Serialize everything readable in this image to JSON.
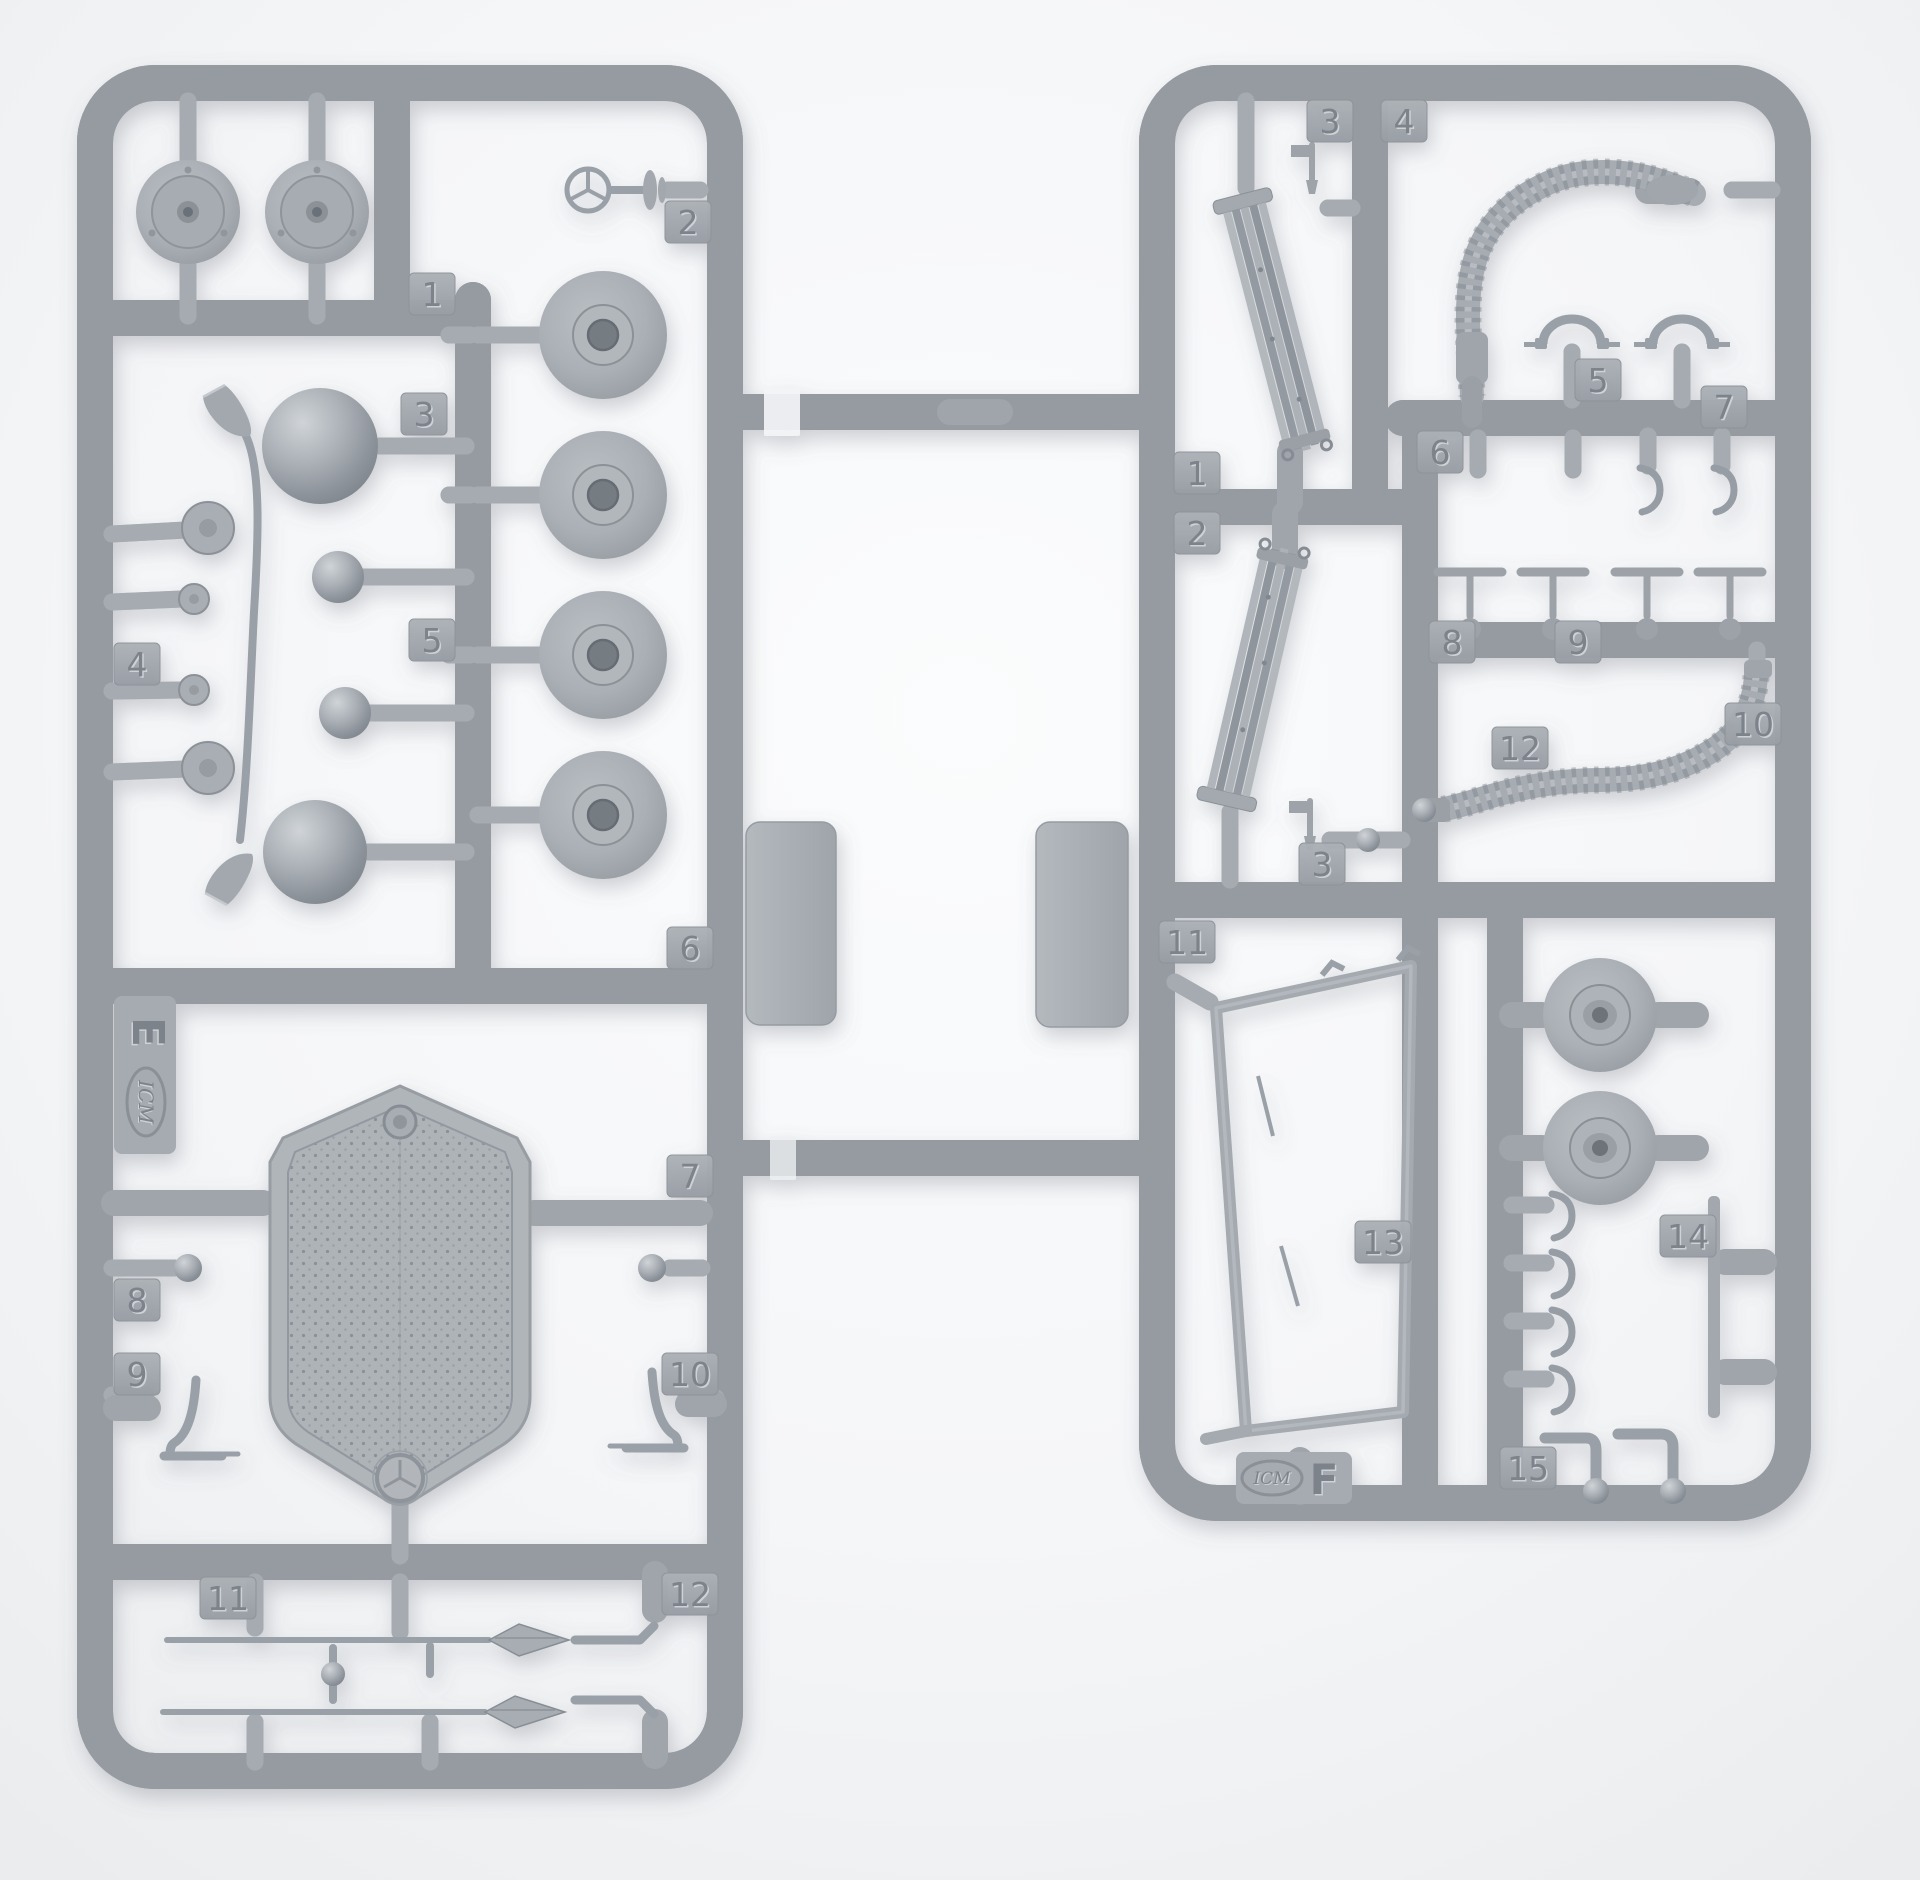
{
  "photo": {
    "subject": "Two light-gray injection-molded plastic model kit sprues photographed on a white background",
    "sprue_count": 2
  },
  "colors": {
    "background": "#f4f5f7",
    "plastic": "#a6abb1",
    "plastic_light": "#ccd0d5",
    "plastic_dark": "#81878e",
    "emboss": "#7d838a",
    "emboss_light": "#ced2d6",
    "sticker": "#f3f4f6"
  },
  "sprue_e": {
    "brand": "ICM",
    "letter": "E",
    "emblem": "three-pointed-star",
    "tags": [
      "1",
      "2",
      "3",
      "4",
      "5",
      "6",
      "7",
      "8",
      "9",
      "10",
      "11",
      "12"
    ]
  },
  "sprue_f": {
    "brand": "ICM",
    "letter": "F",
    "tags": [
      "3",
      "4",
      "1",
      "2",
      "5",
      "7",
      "6",
      "8",
      "9",
      "10",
      "3",
      "11",
      "12",
      "13",
      "14",
      "15"
    ]
  }
}
